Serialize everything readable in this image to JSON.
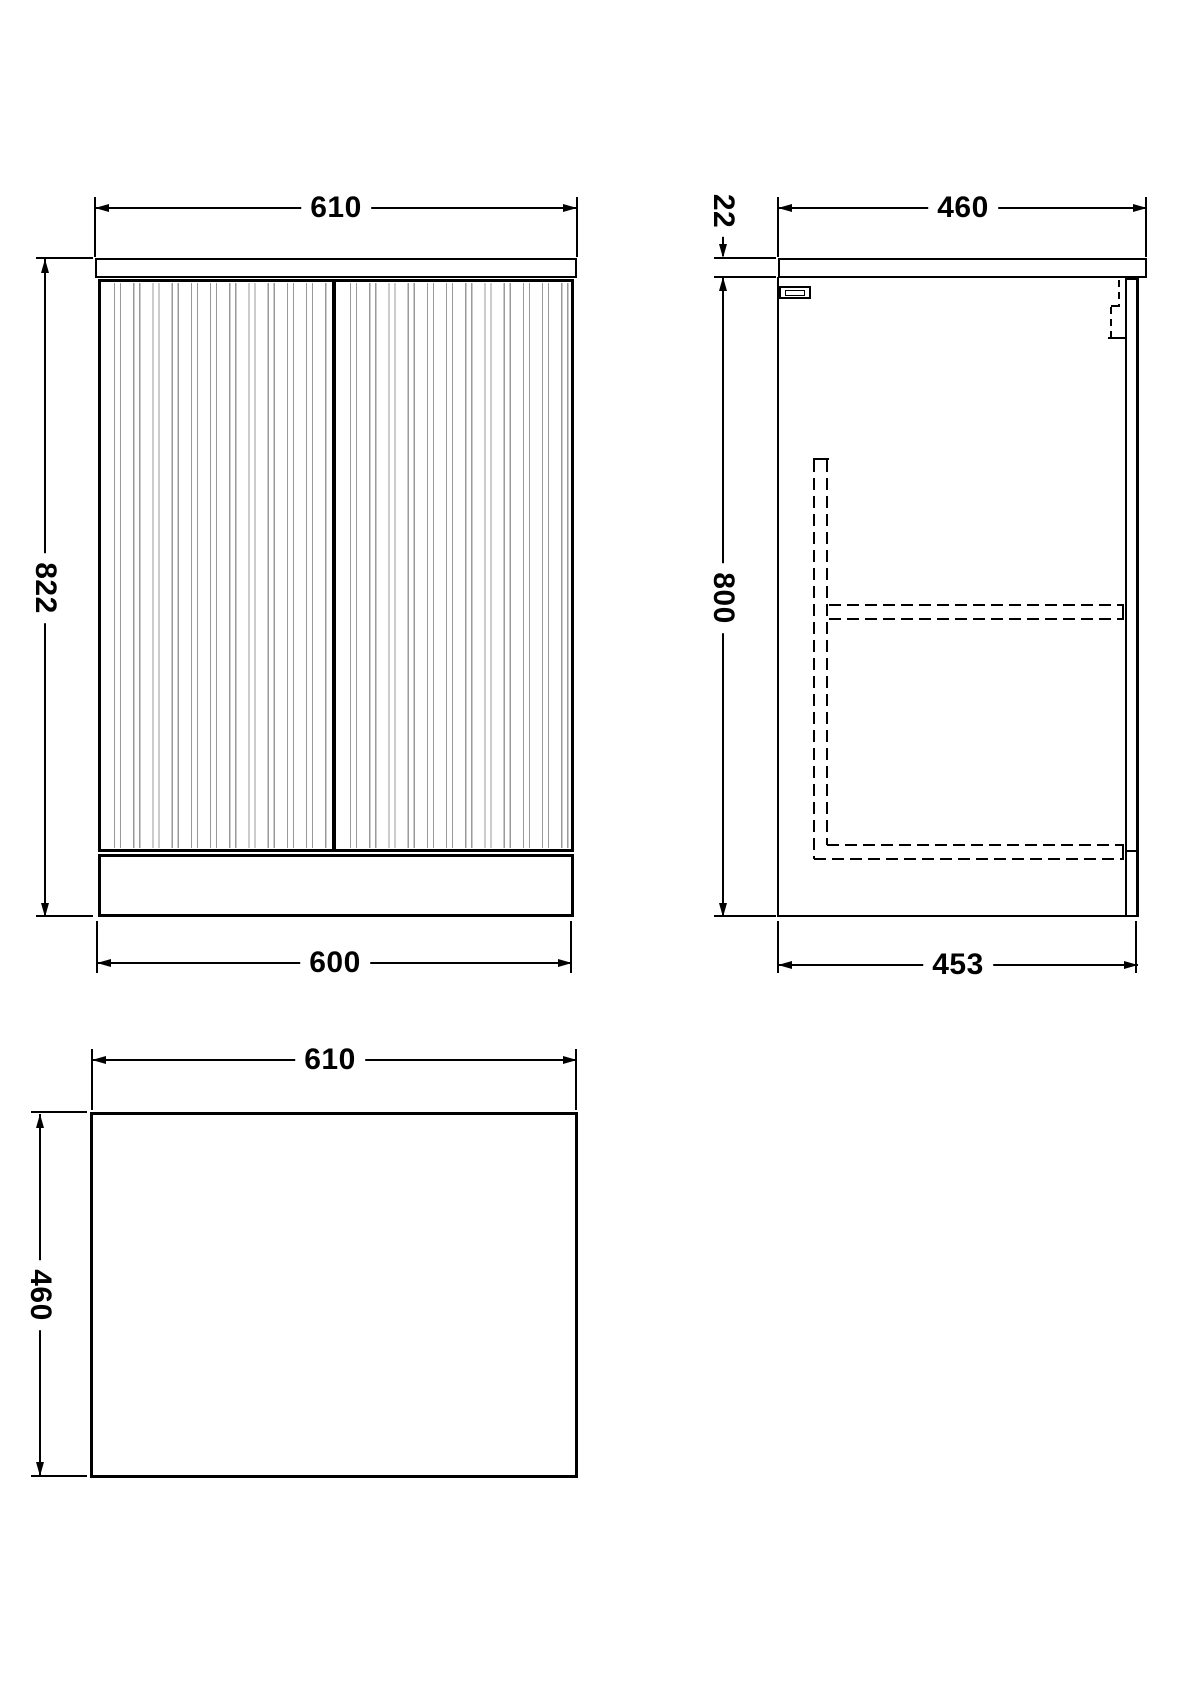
{
  "drawing": {
    "colors": {
      "line": "#000000",
      "flute_line": "#999999",
      "background": "#ffffff"
    },
    "views": {
      "front": {
        "dim_width_top": "610",
        "dim_height": "822",
        "dim_width_bottom": "600"
      },
      "side": {
        "dim_depth_top": "460",
        "dim_worktop_thickness": "22",
        "dim_height": "800",
        "dim_depth_bottom": "453"
      },
      "plan": {
        "dim_width": "610",
        "dim_depth": "460"
      }
    }
  }
}
